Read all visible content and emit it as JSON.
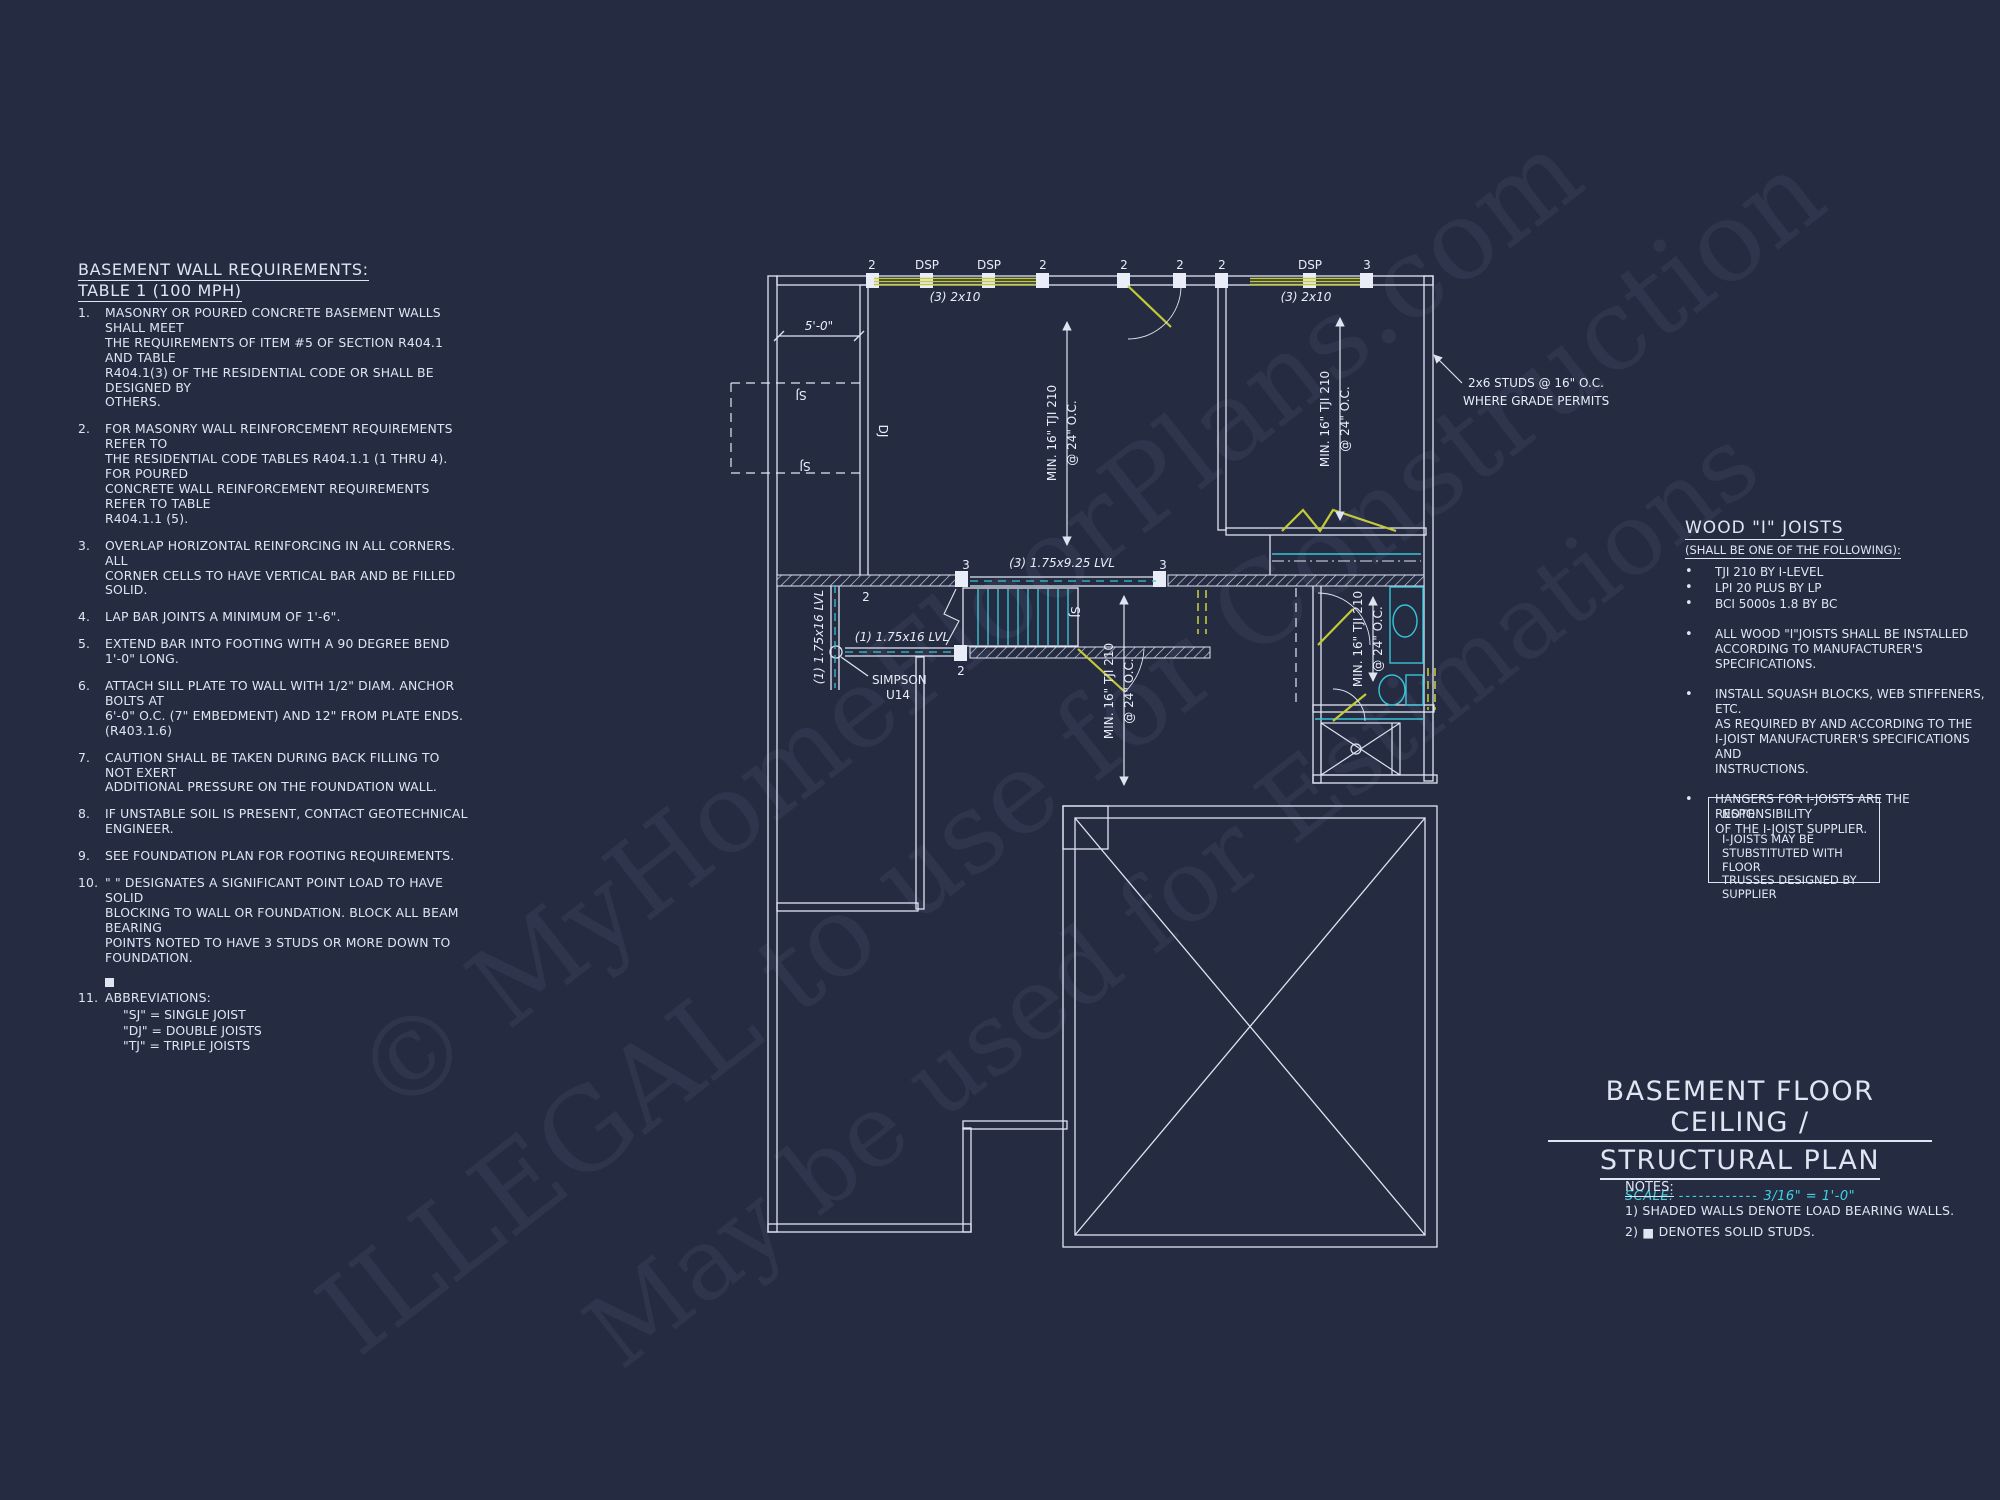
{
  "watermark": {
    "line1": "© MyHomeFloorPlans.com",
    "line2": "ILLEGAL to use for Construction",
    "line3": "May be used for Estimations"
  },
  "left_notes": {
    "title1": "BASEMENT WALL REQUIREMENTS:",
    "title2": "TABLE 1 (100 MPH)",
    "items": [
      {
        "num": "1.",
        "text": "MASONRY OR POURED CONCRETE BASEMENT WALLS SHALL MEET\nTHE REQUIREMENTS OF ITEM #5 OF SECTION R404.1 AND TABLE\nR404.1(3) OF THE RESIDENTIAL CODE OR SHALL BE DESIGNED BY\nOTHERS."
      },
      {
        "num": "2.",
        "text": "FOR MASONRY WALL REINFORCEMENT REQUIREMENTS REFER TO\nTHE RESIDENTIAL CODE TABLES R404.1.1 (1 THRU 4). FOR POURED\nCONCRETE WALL REINFORCEMENT REQUIREMENTS REFER TO TABLE\nR404.1.1 (5)."
      },
      {
        "num": "3.",
        "text": "OVERLAP HORIZONTAL REINFORCING IN ALL CORNERS.  ALL\nCORNER CELLS TO HAVE VERTICAL BAR AND BE FILLED SOLID."
      },
      {
        "num": "4.",
        "text": "LAP BAR JOINTS A MINIMUM OF 1'-6\"."
      },
      {
        "num": "5.",
        "text": "EXTEND BAR INTO FOOTING WITH A 90 DEGREE BEND 1'-0\" LONG."
      },
      {
        "num": "6.",
        "text": "ATTACH SILL PLATE TO WALL WITH 1/2\" DIAM. ANCHOR BOLTS AT\n6'-0\" O.C. (7\" EMBEDMENT) AND 12\" FROM PLATE ENDS. (R403.1.6)"
      },
      {
        "num": "7.",
        "text": "CAUTION SHALL BE TAKEN DURING BACK FILLING TO NOT EXERT\nADDITIONAL PRESSURE ON THE FOUNDATION WALL."
      },
      {
        "num": "8.",
        "text": "IF UNSTABLE SOIL IS PRESENT, CONTACT GEOTECHNICAL ENGINEER."
      },
      {
        "num": "9.",
        "text": "SEE FOUNDATION PLAN FOR FOOTING REQUIREMENTS."
      },
      {
        "num": "10.",
        "text": "\"  \" DESIGNATES A SIGNIFICANT POINT LOAD TO HAVE SOLID\nBLOCKING TO WALL OR FOUNDATION.  BLOCK ALL BEAM BEARING\nPOINTS NOTED TO HAVE 3 STUDS OR MORE DOWN TO FOUNDATION."
      },
      {
        "num": "11.",
        "text": "ABBREVIATIONS:"
      }
    ],
    "abbreviations": [
      "\"SJ\" = SINGLE JOIST",
      "\"DJ\" = DOUBLE JOISTS",
      "\"TJ\" = TRIPLE JOISTS"
    ]
  },
  "wood_joists": {
    "title": "WOOD \"I\" JOISTS",
    "subtitle": "(SHALL BE ONE OF THE FOLLOWING):",
    "bullet": "•",
    "options": [
      "TJI 210 BY I-LEVEL",
      "LPI 20 PLUS BY LP",
      "BCI 5000s 1.8 BY BC"
    ],
    "notes": [
      "ALL WOOD \"I\"JOISTS SHALL BE INSTALLED\nACCORDING TO MANUFACTURER'S\nSPECIFICATIONS.",
      "INSTALL SQUASH BLOCKS, WEB STIFFENERS, ETC.\nAS REQUIRED BY AND ACCORDING TO THE\nI-JOIST MANUFACTURER'S SPECIFICATIONS AND\nINSTRUCTIONS.",
      "HANGERS FOR I-JOISTS ARE THE RESPONSIBILITY\nOF THE I-JOIST SUPPLIER."
    ]
  },
  "note_box": {
    "title": "NOTE:",
    "body": "I-JOISTS MAY BE\nSTUBSTITUTED WITH FLOOR\nTRUSSES DESIGNED BY\nSUPPLIER"
  },
  "title_block": {
    "line1": "BASEMENT FLOOR CEILING /",
    "line2": "STRUCTURAL PLAN",
    "scale_label": "SCALE:",
    "scale_dots": "------------",
    "scale_value": "3/16\" = 1'-0\"",
    "notes_title": "NOTES:",
    "note1": "1) SHADED WALLS DENOTE LOAD BEARING WALLS.",
    "note2_pre": "2)",
    "note2_icon": "■",
    "note2_text": "DENOTES SOLID STUDS."
  },
  "plan": {
    "labels": {
      "n2": "2",
      "n3": "3",
      "dsp": "DSP",
      "beam2x10": "(3) 2x10",
      "dim5": "5'-0\"",
      "sj": "SJ",
      "dj": "DJ",
      "tji_l1": "MIN. 16\" TJI 210",
      "tji_l2": "@ 24\" O.C.",
      "studs1": "2x6 STUDS @ 16\" O.C.",
      "studs2": "WHERE GRADE PERMITS",
      "lvl925": "(3) 1.75x9.25 LVL",
      "lvl16": "(1) 1.75x16 LVL",
      "simpson1": "SIMPSON",
      "simpson2": "U14"
    }
  },
  "colors": {
    "background": "#252c42",
    "line_white": "#dfe5f0",
    "cyan": "#38c3d6",
    "scale_cyan": "#3fd2e2",
    "yellow": "#c3c937"
  }
}
